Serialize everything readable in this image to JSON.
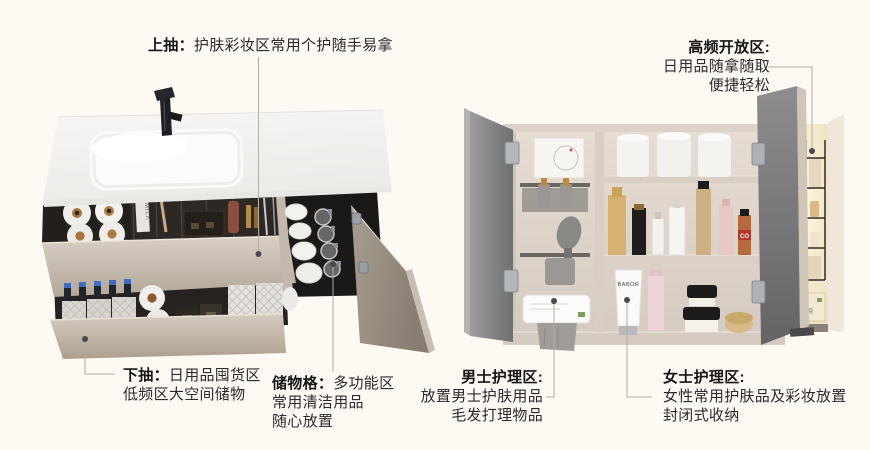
{
  "canvas": {
    "width": 870,
    "height": 450,
    "background": "#fff9f4"
  },
  "annotations": {
    "top_drawer": {
      "label": "上抽：",
      "text": "护肤彩妆区常用个护随手易拿"
    },
    "high_frequency": {
      "label": "高频开放区:",
      "line1": "日用品随拿随取",
      "line2": "便捷轻松"
    },
    "bottom_drawer": {
      "label": "下抽：",
      "line1": "日用品囤货区",
      "line2": "低频区大空间储物"
    },
    "storage_grid": {
      "label": "储物格：",
      "line1": "多功能区",
      "line2": "常用清洁用品",
      "line3": "随心放置"
    },
    "mens_care": {
      "label": "男士护理区:",
      "line1": "放置男士护肤用品",
      "line2": "毛发打理物品"
    },
    "womens_care": {
      "label": "女士护理区:",
      "line1": "女性常用护肤品及彩妆放置",
      "line2": "封闭式收纳"
    }
  },
  "product_texts": {
    "milk_carton": "MILK",
    "tube_brand": "BABOR",
    "box_weight": "800g",
    "canister_label": "CO"
  },
  "colors": {
    "background": "#fff9f4",
    "cabinet_greige": "#cdc3b7",
    "countertop_white": "#f4f3f1",
    "door_gray": "#85868a",
    "glow_warm": "#f8eed2",
    "connector_line": "#b3aca5",
    "connector_dot": "#4a4a4a",
    "text_dark": "#141414"
  }
}
